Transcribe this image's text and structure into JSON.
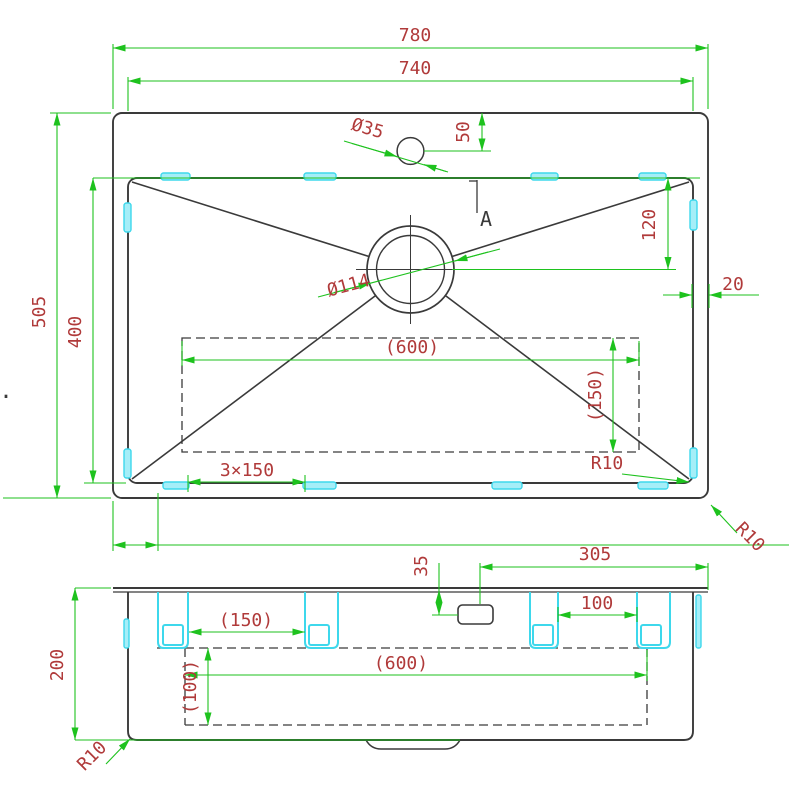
{
  "drawing": {
    "type": "technical-cad-sink-drawing",
    "colors": {
      "dimension_line": "#1ec21e",
      "dimension_text": "#b03a3a",
      "geometry": "#3a3a3a",
      "clip_accent": "#3ed8ec"
    },
    "labels": {
      "top": {
        "overall_width": "780",
        "inner_width": "740",
        "overall_depth": "505",
        "bowl_depth": "400",
        "faucet_hole_dia": "Ø35",
        "faucet_offset": "50",
        "drain_dia": "Ø114",
        "drain_offset": "120",
        "rim_gap": "20",
        "base_length": "(600)",
        "base_width": "(150)",
        "clip_pitch": "3×150",
        "bowl_corner_radius": "R10",
        "rim_corner_radius": "R10",
        "section_mark": "A",
        "stray_dot": "."
      },
      "side": {
        "drain_offset_x": "305",
        "drain_drop": "35",
        "bracket_pitch_right": "100",
        "bracket_pitch_left": "(150)",
        "base_length": "(600)",
        "base_height": "(100)",
        "overall_height": "200",
        "corner_radius": "R10"
      }
    }
  }
}
